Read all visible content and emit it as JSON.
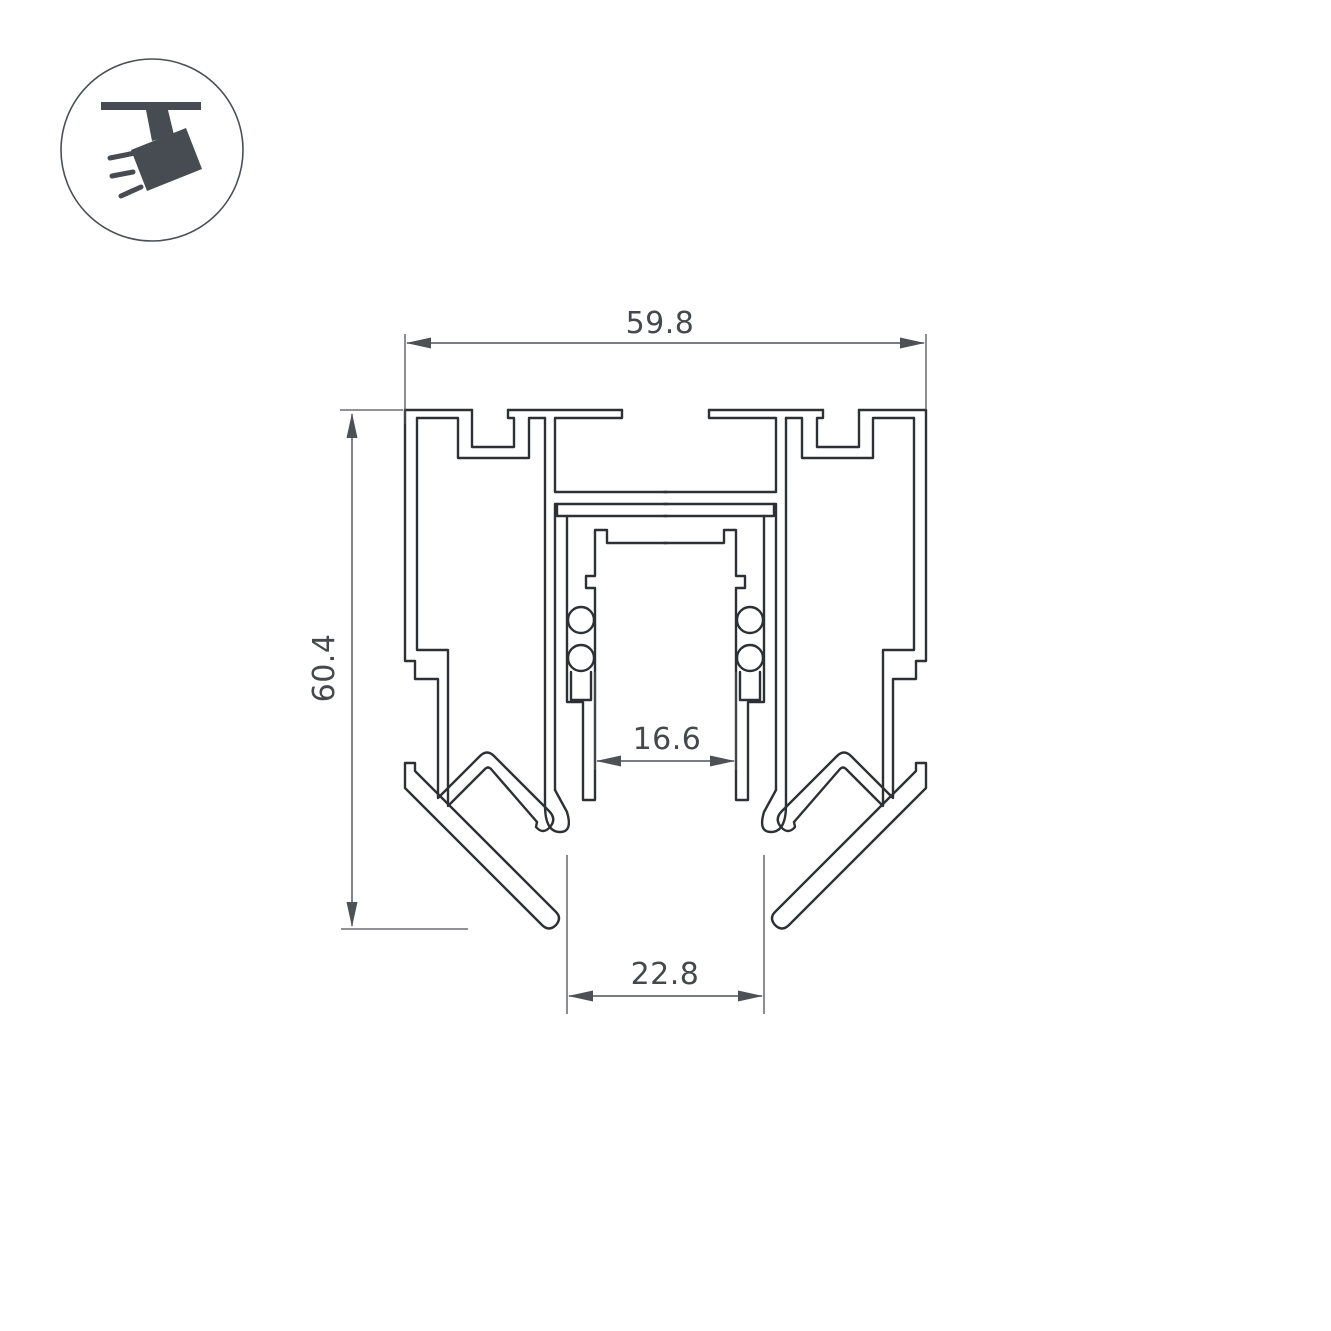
{
  "title": "Corner magnetic track profile cross-section drawing",
  "logo": {
    "name": "track-spotlight-logo",
    "color": "#474c52",
    "ring_color": "#4a4f55"
  },
  "drawing": {
    "type": "technical-cross-section",
    "part": "aluminum corner profile with magnetic track channel"
  },
  "dimensions": {
    "width_top": {
      "value": "59.8",
      "orientation": "horizontal",
      "position": "top"
    },
    "height_left": {
      "value": "60.4",
      "orientation": "vertical",
      "position": "left"
    },
    "inner_width": {
      "value": "16.6",
      "orientation": "horizontal",
      "position": "middle"
    },
    "bottom_width": {
      "value": "22.8",
      "orientation": "horizontal",
      "position": "bottom"
    }
  },
  "colors": {
    "line": "#2d3136",
    "dim": "#4d5156",
    "text": "#45494e",
    "background": "#ffffff"
  }
}
